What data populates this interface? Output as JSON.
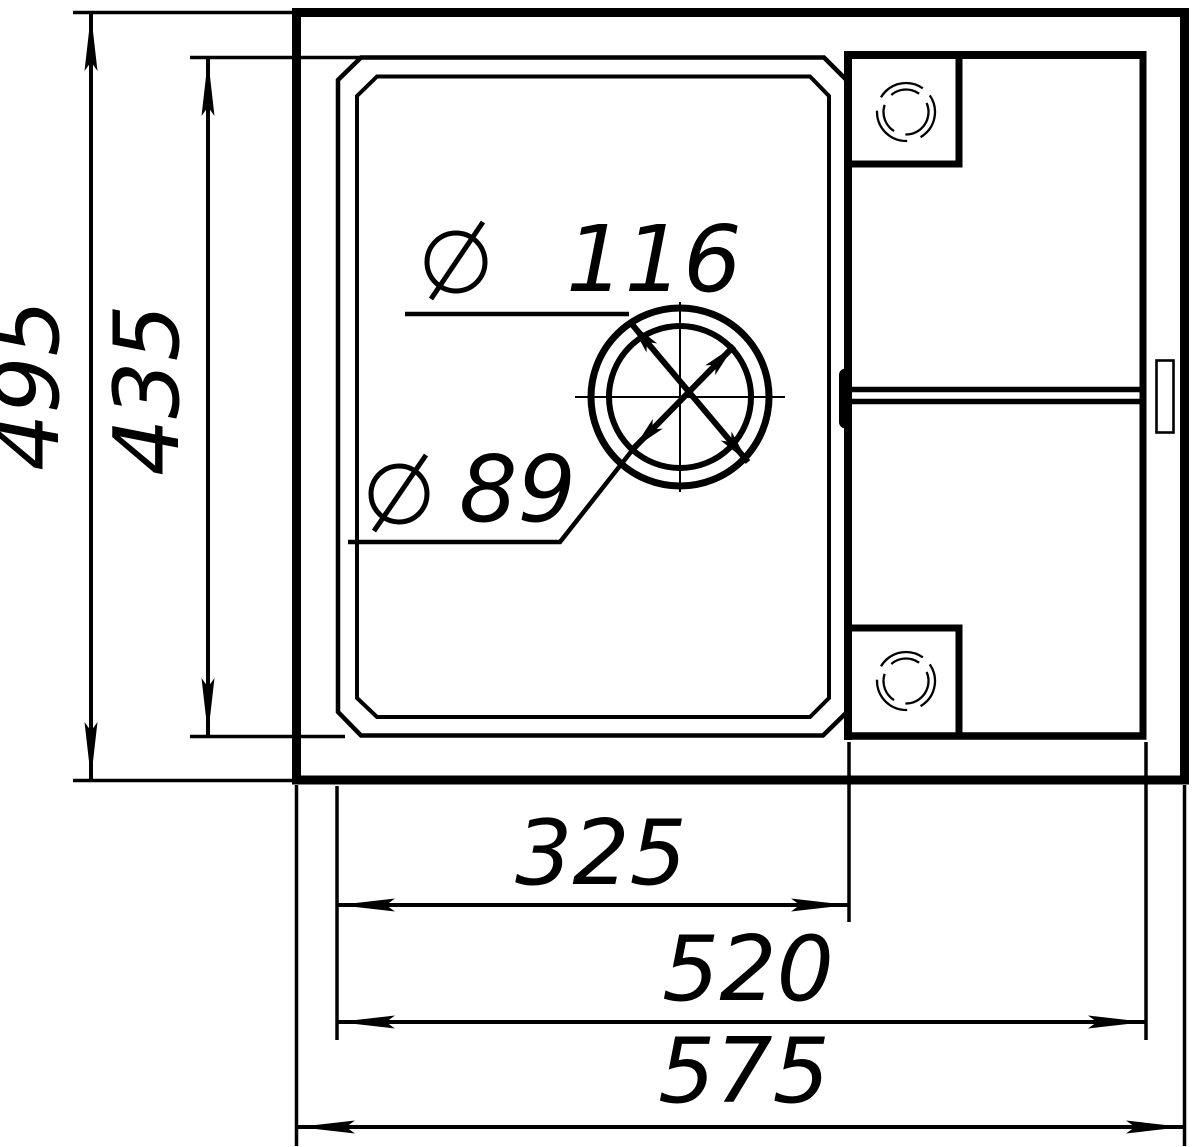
{
  "drawing": {
    "title": "Sink top-view dimension drawing",
    "background": "#ffffff",
    "line_color": "#000000",
    "dimensions": {
      "overall_width": "575",
      "rim_width": "520",
      "bowl_width": "325",
      "overall_depth": "495",
      "bowl_depth": "435"
    },
    "drain": {
      "outer_diameter": "116",
      "inner_diameter": "89"
    }
  }
}
